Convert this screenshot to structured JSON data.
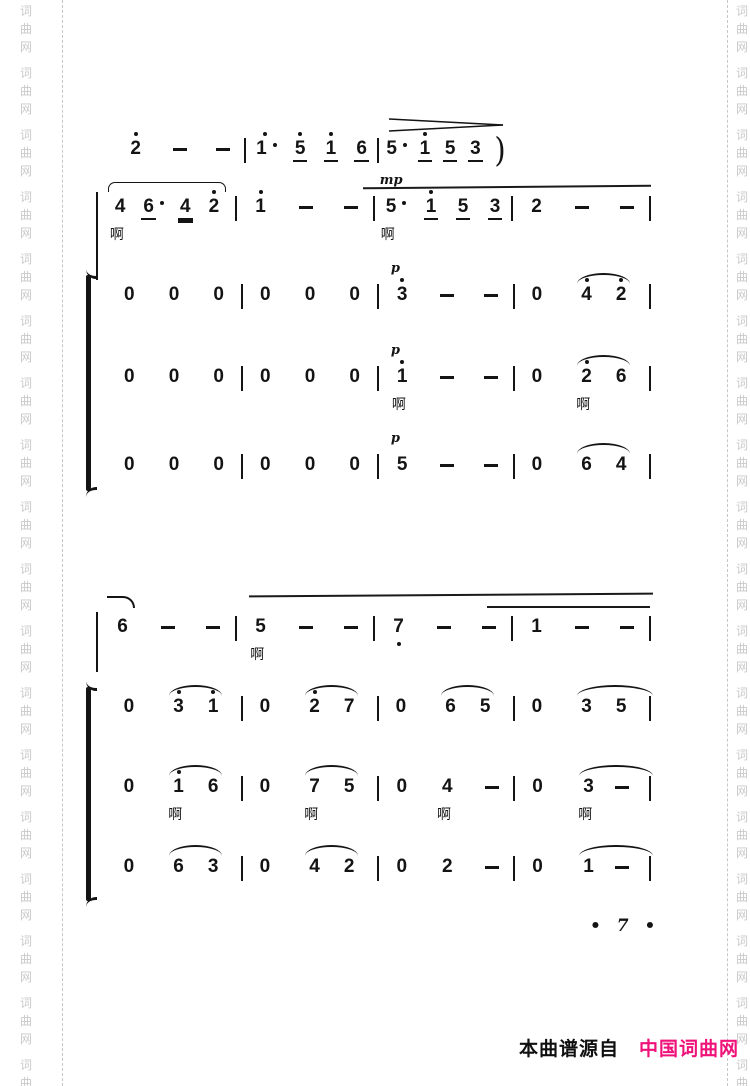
{
  "watermark": {
    "chars": [
      "词",
      "曲",
      "网"
    ],
    "color": "#c9c9c9"
  },
  "page_number": {
    "label": "• 7 •"
  },
  "footer": {
    "source_label": "本曲谱源自",
    "site_name": "中国词曲网",
    "site_color": "#ef1279",
    "text_color": "#101010"
  },
  "notation": {
    "systems": [
      {
        "name": "system-1",
        "staves": [
          {
            "id": "melody-line-1",
            "end_bar": false,
            "measures": [
              [
                "2'",
                "-",
                "-"
              ],
              [
                "1'.",
                "5'_",
                "1'_",
                "6_"
              ],
              [
                "5.",
                "1'_",
                "5_",
                "3_",
                ")"
              ]
            ]
          },
          {
            "id": "melody-line-2",
            "end_bar": true,
            "measures": [
              [
                {
                  "s": [
                    {
                      "t": "4",
                      "lyric": "啊"
                    },
                    "6_.",
                    "4=",
                    "2'"
                  ],
                  "phrase": true
                }
              ],
              [
                "1'",
                "-",
                "-"
              ],
              [
                {
                  "t": "5.",
                  "dyn": "mp",
                  "lyric": "啊"
                },
                "1'_",
                "5_",
                "3_"
              ],
              [
                "2",
                "-",
                "-"
              ]
            ]
          },
          {
            "id": "choir-voice-1",
            "end_bar": true,
            "measures": [
              [
                "0",
                "0",
                "0"
              ],
              [
                "0",
                "0",
                "0"
              ],
              [
                {
                  "t": "3'",
                  "dyn": "p"
                },
                "-",
                "-"
              ],
              [
                "0",
                {
                  "s": [
                    "4'",
                    "2'"
                  ]
                }
              ]
            ]
          },
          {
            "id": "choir-voice-2",
            "end_bar": true,
            "measures": [
              [
                "0",
                "0",
                "0"
              ],
              [
                "0",
                "0",
                "0"
              ],
              [
                {
                  "t": "1'",
                  "dyn": "p",
                  "lyric": "啊"
                },
                "-",
                "-"
              ],
              [
                "0",
                {
                  "s": [
                    {
                      "t": "2'",
                      "lyric": "啊"
                    },
                    "6"
                  ]
                }
              ]
            ]
          },
          {
            "id": "choir-voice-3",
            "end_bar": true,
            "measures": [
              [
                "0",
                "0",
                "0"
              ],
              [
                "0",
                "0",
                "0"
              ],
              [
                {
                  "t": "5",
                  "dyn": "p"
                },
                "-",
                "-"
              ],
              [
                "0",
                {
                  "s": [
                    "6",
                    "4"
                  ]
                }
              ]
            ]
          }
        ]
      },
      {
        "name": "system-2",
        "staves": [
          {
            "id": "melody-line-3",
            "end_bar": true,
            "measures": [
              [
                "6",
                "-",
                "-"
              ],
              [
                {
                  "t": "5",
                  "lyric": "啊"
                },
                "-",
                "-"
              ],
              [
                "7,",
                "-",
                "-"
              ],
              [
                "1",
                "-",
                "-"
              ]
            ]
          },
          {
            "id": "choir-voice-1",
            "end_bar": true,
            "measures": [
              [
                "0",
                {
                  "s": [
                    "3'",
                    "1'"
                  ]
                }
              ],
              [
                "0",
                {
                  "s": [
                    "2'",
                    "7"
                  ]
                }
              ],
              [
                "0",
                {
                  "s": [
                    "6",
                    "5"
                  ]
                }
              ],
              [
                "0",
                {
                  "s": [
                    "3",
                    "5"
                  ],
                  "ext": true
                }
              ]
            ]
          },
          {
            "id": "choir-voice-2",
            "end_bar": true,
            "measures": [
              [
                "0",
                {
                  "s": [
                    {
                      "t": "1'",
                      "lyric": "啊"
                    },
                    "6"
                  ]
                }
              ],
              [
                "0",
                {
                  "s": [
                    {
                      "t": "7",
                      "lyric": "啊"
                    },
                    "5"
                  ]
                }
              ],
              [
                "0",
                {
                  "t": "4",
                  "lyric": "啊"
                },
                "-"
              ],
              [
                "0",
                {
                  "s": [
                    {
                      "t": "3",
                      "lyric": "啊"
                    },
                    "-"
                  ],
                  "ext": true
                }
              ]
            ]
          },
          {
            "id": "choir-voice-3",
            "end_bar": true,
            "measures": [
              [
                "0",
                {
                  "s": [
                    "6",
                    "3"
                  ]
                }
              ],
              [
                "0",
                {
                  "s": [
                    "4",
                    "2"
                  ]
                }
              ],
              [
                "0",
                "2",
                "-"
              ],
              [
                "0",
                {
                  "s": [
                    "1",
                    "-"
                  ],
                  "ext": true
                }
              ]
            ]
          }
        ]
      }
    ]
  }
}
